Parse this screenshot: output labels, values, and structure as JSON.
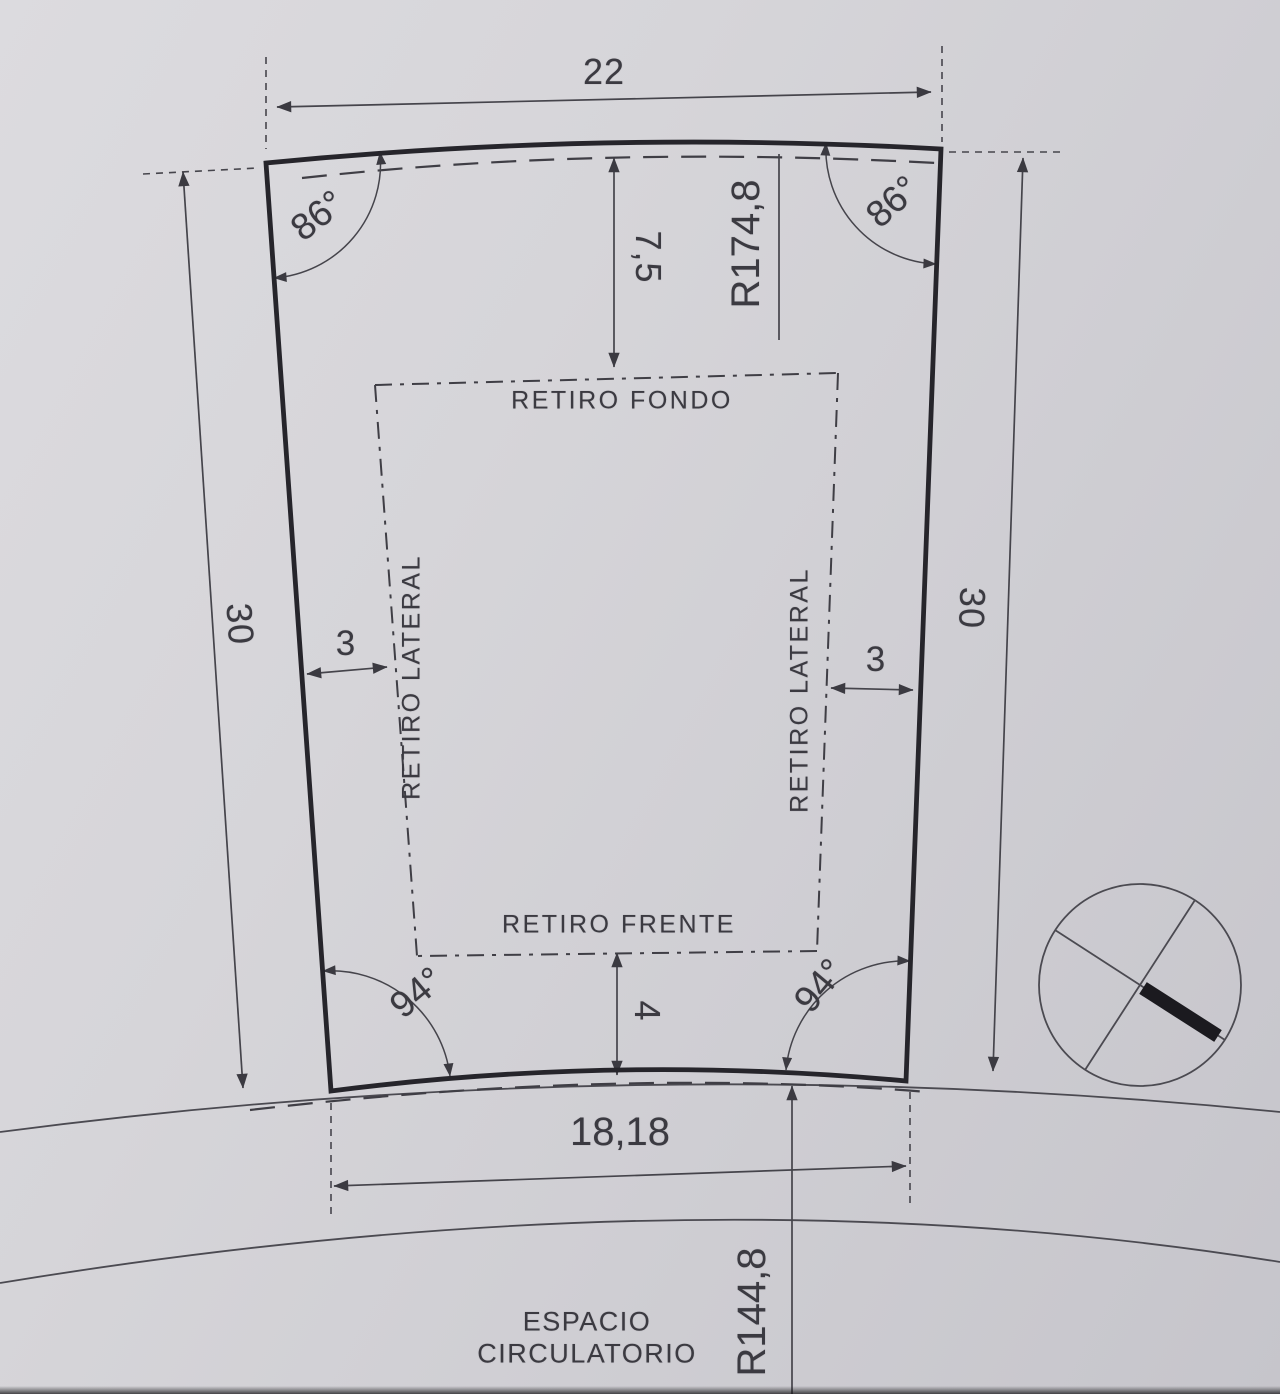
{
  "page": {
    "paper_color": "#d3d2d7",
    "ink_color": "#3b3a41",
    "outline_color": "#26252b"
  },
  "parcel": {
    "top_width": "22",
    "left_depth": "30",
    "right_depth": "30",
    "front_width": "18,18",
    "angles": {
      "top_left": "86°",
      "top_right": "86°",
      "bottom_left": "94°",
      "bottom_right": "94°"
    },
    "radii": {
      "rear": "R174,8",
      "front": "R144,8"
    }
  },
  "setbacks": {
    "rear_label": "RETIRO FONDO",
    "rear_value": "7,5",
    "front_label": "RETIRO FRENTE",
    "front_value": "4",
    "left_label": "RETIRO LATERAL",
    "left_value": "3",
    "right_label": "RETIRO LATERAL",
    "right_value": "3"
  },
  "road": {
    "label_line1": "ESPACIO",
    "label_line2": "CIRCULATORIO"
  },
  "symbols": {
    "north": "north-cross-circle"
  }
}
